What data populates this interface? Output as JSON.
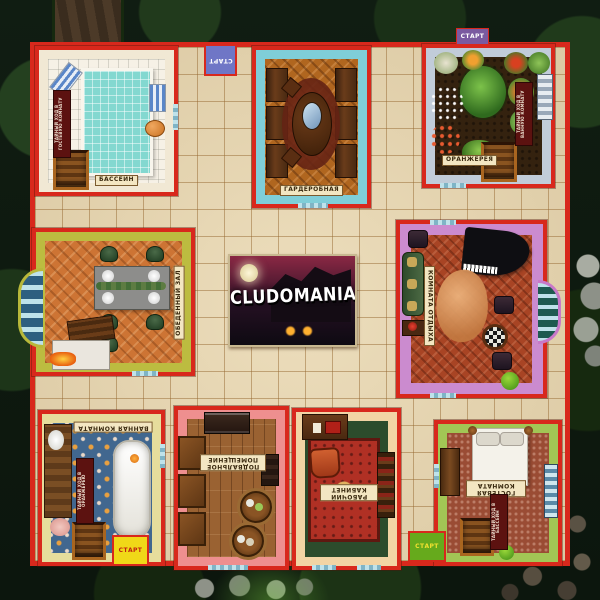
{
  "game": {
    "title": "CLUDOMANIA",
    "start_label": "СТАРТ"
  },
  "rooms": {
    "pool": {
      "label": "БАССЕЙН",
      "secret_passage": "ТАЙНЫЙ ХОД В ГОСТЕВУЮ КОМНАТУ"
    },
    "wardrobe": {
      "label": "ГАРДЕРОБНАЯ"
    },
    "conservatory": {
      "label": "ОРАНЖЕРЕЯ",
      "secret_passage": "ТАЙНЫЙ ХОД В ВАННУЮ КОМНАТУ"
    },
    "dining": {
      "label": "ОБЕДЕННЫЙ ЗАЛ"
    },
    "lounge": {
      "label": "КОМНАТА ОТДЫХА"
    },
    "bathroom": {
      "label": "ВАННАЯ КОМНАТА",
      "secret_passage": "ТАЙНЫЙ ХОД В ОРАНЖЕРЕЮ"
    },
    "cellar": {
      "label": "ПОДВАЛЬНОЕ ПОМЕЩЕНИЕ"
    },
    "study": {
      "label": "РАБОЧИЙ КАБИНЕТ"
    },
    "guest": {
      "label": "ГОСТЕВАЯ КОМНАТА",
      "secret_passage": "ТАЙНЫЙ ХОД В БАССЕЙН"
    }
  },
  "colors": {
    "board_border": "#d8281c",
    "corridor_tile": "#ead9b3",
    "garden_background": "#101d12",
    "start_top": "#6f76c6",
    "start_bottom_left": "#f0d818",
    "start_bottom_right": "#66aa1c"
  }
}
